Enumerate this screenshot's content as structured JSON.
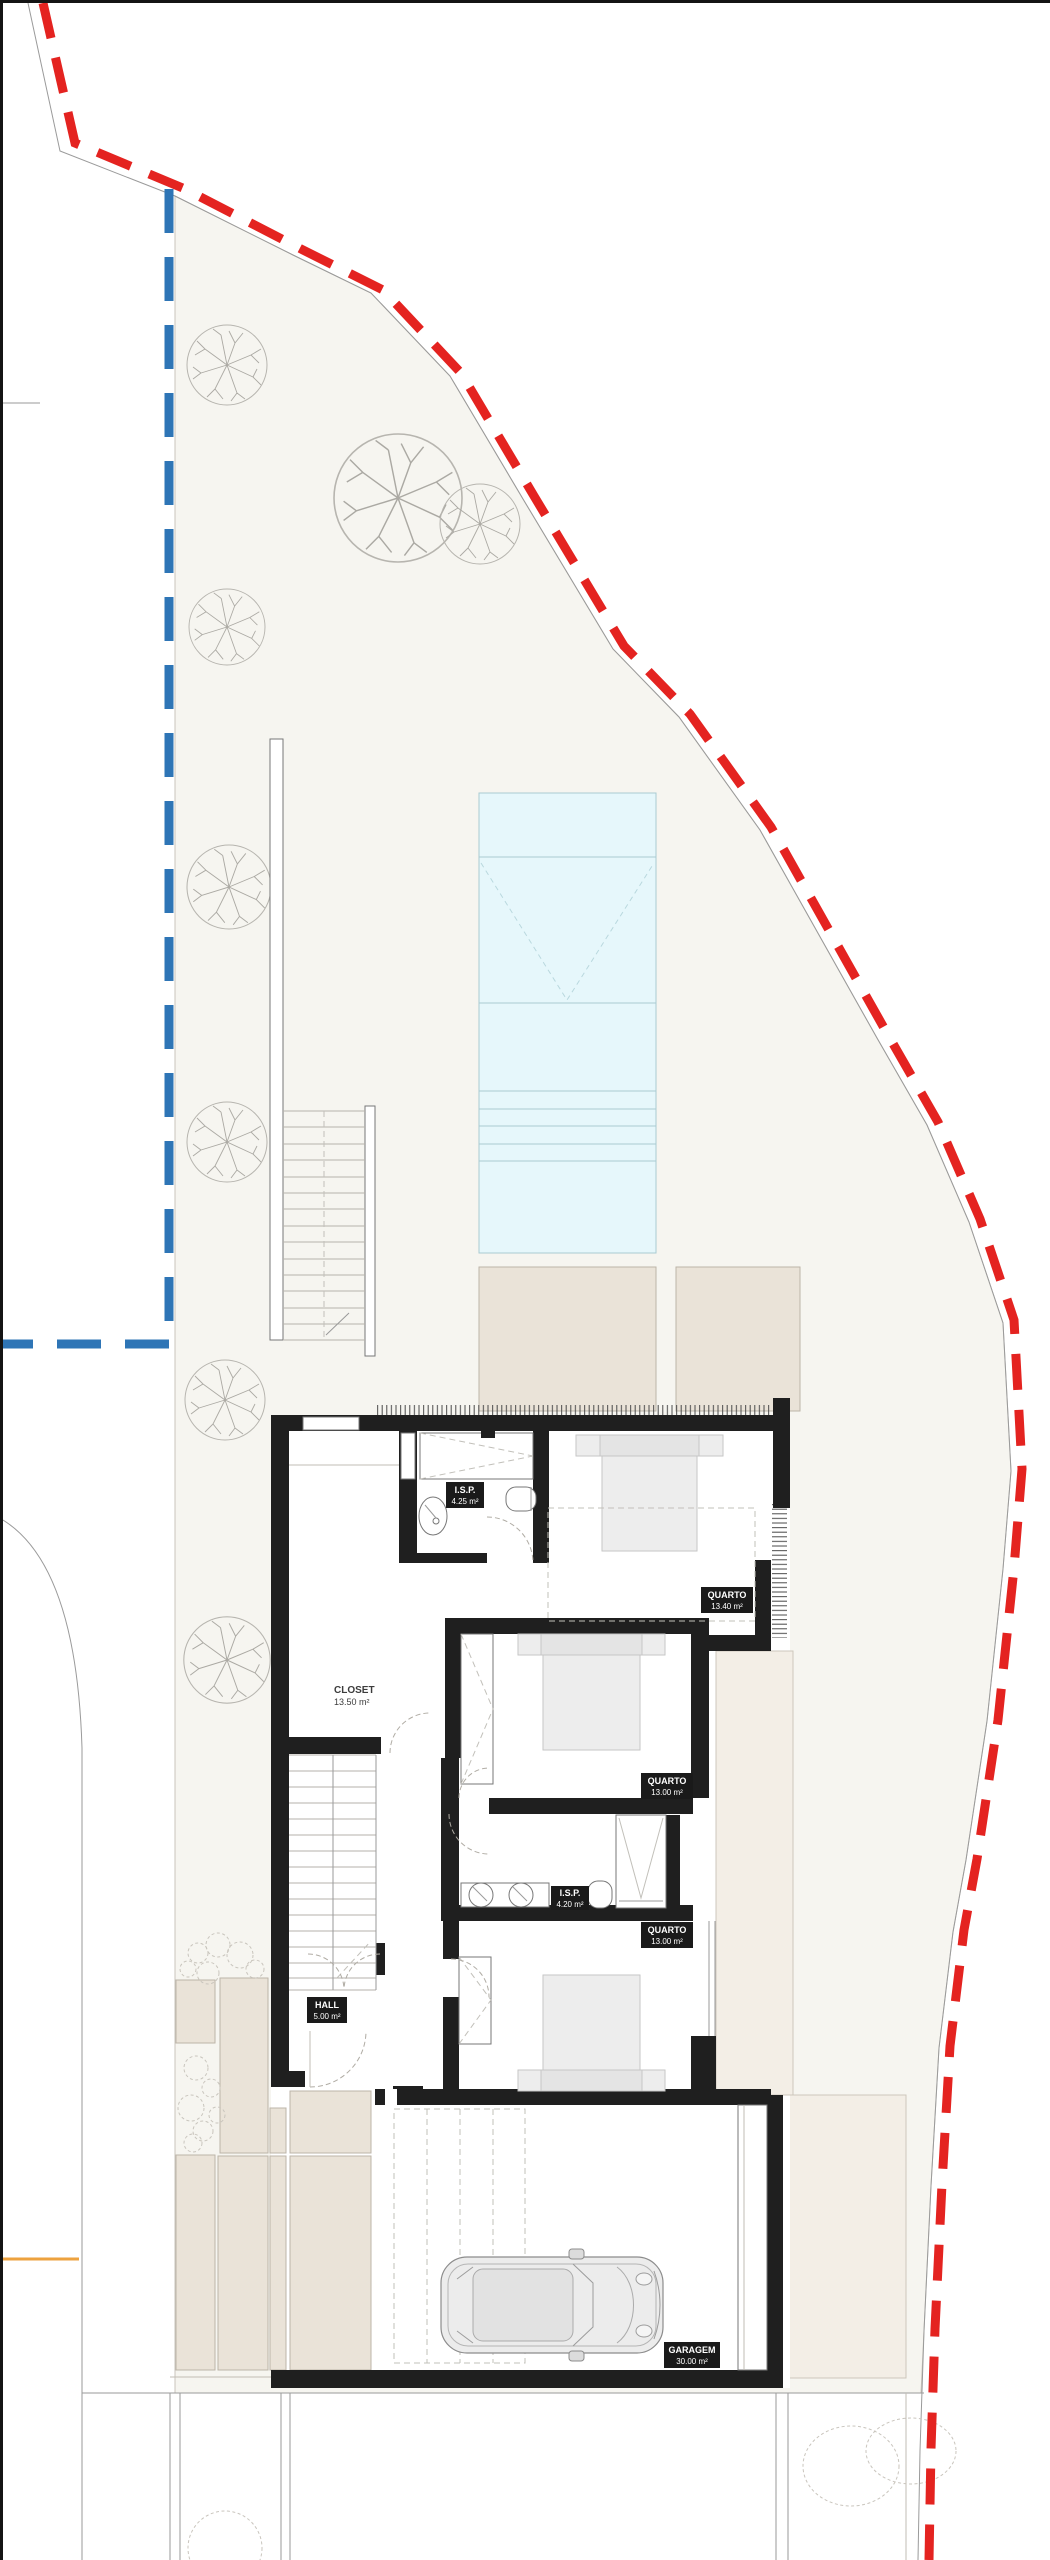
{
  "plan_title": "Site / upper floor plan",
  "rooms": {
    "quarto1": {
      "name": "QUARTO",
      "area": "13.40 m²"
    },
    "isp1": {
      "name": "I.S.P.",
      "area": "4.25 m²"
    },
    "closet": {
      "name": "CLOSET",
      "area": "13.50 m²"
    },
    "quarto2": {
      "name": "QUARTO",
      "area": "13.00 m²"
    },
    "isp2": {
      "name": "I.S.P.",
      "area": "4.20 m²"
    },
    "quarto3": {
      "name": "QUARTO",
      "area": "13.00 m²"
    },
    "hall": {
      "name": "HALL",
      "area": "5.00 m²"
    },
    "garagem": {
      "name": "GARAGEM",
      "area": "30.00 m²"
    }
  },
  "colors": {
    "boundary_red": "#e42320",
    "setback_blue": "#2e75b6",
    "pool_water": "#e6f7fb",
    "pool_line": "#a9cbd2",
    "site_fill": "#f6f5f0",
    "paving": "#eae3d8",
    "terrace": "#f3eee6",
    "wall": "#1f1f1f",
    "accent_orange": "#eda23f"
  }
}
